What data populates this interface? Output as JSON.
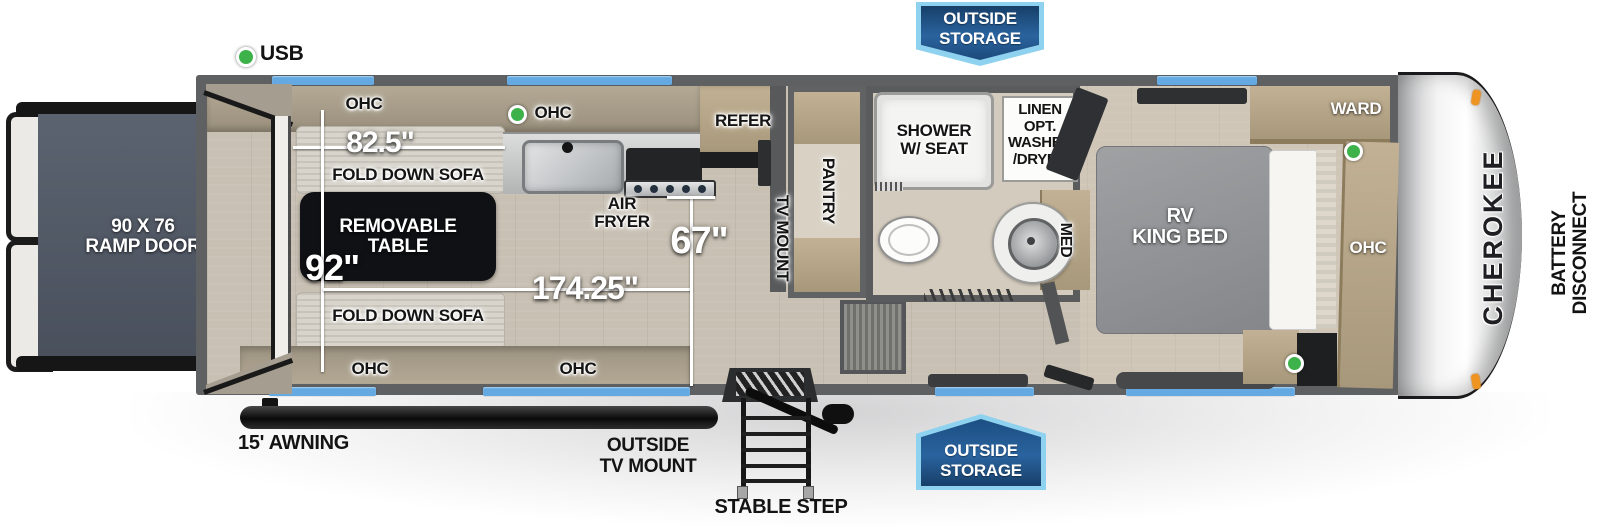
{
  "colors": {
    "wall_gray": "#5e6062",
    "floor_tan": "#c8c0b3",
    "wood": "#b5a488",
    "window_blue": "#64a9e2",
    "banner_blue_dark": "#173f69",
    "banner_blue_light": "#2a639e",
    "banner_border": "#8ed2ef",
    "usb_green": "#3db24a",
    "marker_orange": "#ef9420",
    "ramp_slate": "#525a66"
  },
  "exterior": {
    "usb_label": "USB",
    "storage_top": "OUTSIDE\nSTORAGE",
    "storage_bottom": "OUTSIDE\nSTORAGE",
    "awning_label": "15' AWNING",
    "tv_mount_label": "OUTSIDE\nTV MOUNT",
    "step_label": "STABLE STEP",
    "brand_label": "CHEROKEE",
    "battery_label": "BATTERY\nDISCONNECT",
    "ramp_label": "90 X 76\nRAMP DOOR"
  },
  "garage": {
    "ohc_top_label": "OHC",
    "sofa_top_dim": "82.5\"",
    "sofa_top_label": "FOLD DOWN SOFA",
    "table_label": "REMOVABLE\nTABLE",
    "width_dim": "92\"",
    "sofa_bottom_label": "FOLD DOWN SOFA",
    "length_dim": "174.25\"",
    "height_dim": "67\"",
    "ohc_bottom_left_label": "OHC",
    "ohc_bottom_right_label": "OHC"
  },
  "kitchen": {
    "ohc_label": "OHC",
    "air_fryer_label": "AIR\nFRYER",
    "refer_label": "REFER"
  },
  "hall": {
    "tv_mount_label": "TV MOUNT",
    "pantry_label": "PANTRY"
  },
  "bathroom": {
    "shower_label": "SHOWER\nW/ SEAT",
    "linen_label": "LINEN\nOPT.\nWASHER\n/DRYER",
    "med_label": "MED"
  },
  "bedroom": {
    "bed_label": "RV\nKING BED",
    "ward_label": "WARD",
    "ohc_label": "OHC"
  }
}
